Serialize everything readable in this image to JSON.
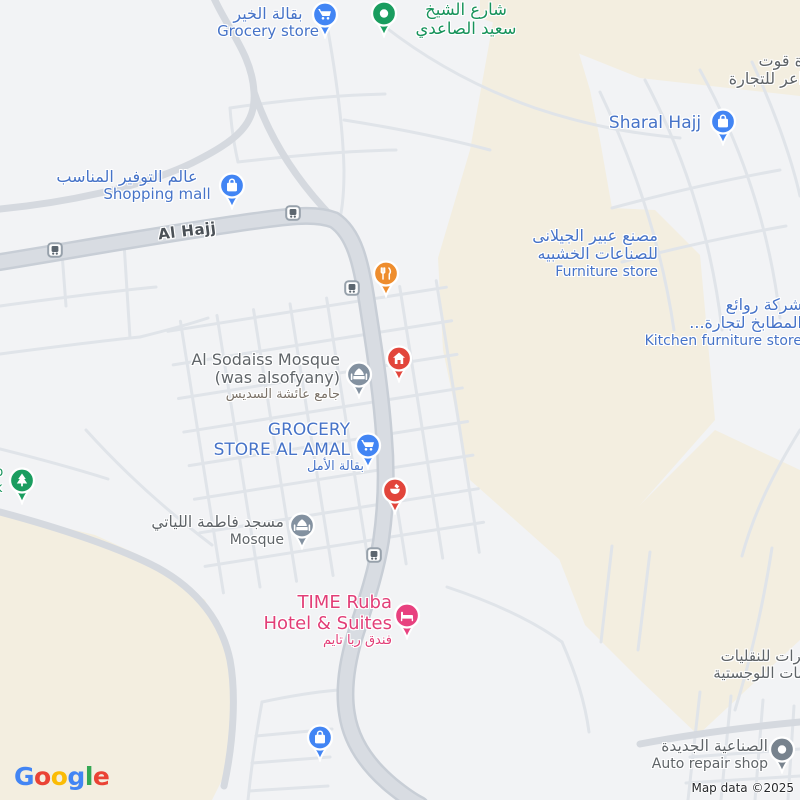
{
  "attribution": "Map data ©2025",
  "logo": {
    "letters": [
      "G",
      "o",
      "o",
      "g",
      "l",
      "e"
    ]
  },
  "colors": {
    "poi_label_blue": "#4673c8",
    "street_green": "#17935b",
    "hotel_pink": "#e23e77",
    "label_gray": "#5f6468",
    "marker_blue": "#4285f4",
    "marker_red": "#e2453b",
    "marker_orange": "#ee8d2e",
    "marker_gray": "#8391a0",
    "marker_pink": "#e8417f",
    "marker_green": "#1a9d5f",
    "landuse_beige": "#f3eee0",
    "road_fill": "#d8dce2"
  },
  "roads": {
    "al_hajj": "Al Hajj"
  },
  "street_names": {
    "sheikh_l1": "شارع الشيخ",
    "sheikh_l2": "سعيد الصاعدي"
  },
  "pois": {
    "grocery_khair": {
      "ar": "بقالة الخير",
      "en": "Grocery store",
      "marker": "cart-blue"
    },
    "qut_trading": {
      "l1": "ة قوت",
      "l2": "اعر للتجارة"
    },
    "sharal_hajj": {
      "en": "Sharal Hajj",
      "marker": "bag-blue"
    },
    "shopping_mall": {
      "ar": "عالم التوفير المناسب",
      "en": "Shopping mall",
      "marker": "bag-blue"
    },
    "furniture_store": {
      "ar1": "مصنع عبير الجيلانى",
      "ar2": "للصناعات الخشبيه",
      "en": "Furniture store",
      "marker": "bag-blue"
    },
    "kitchen_store": {
      "ar1": "شركة روائع",
      "ar2": "المطابخ لتجارة...",
      "en": "Kitchen furniture store"
    },
    "sodaiss_mosque": {
      "en1": "Al Sodaiss Mosque",
      "en2": "(was alsofyany)",
      "ar": "جامع عائشة السديس",
      "marker": "mosque-gray"
    },
    "home": {
      "marker": "home-red"
    },
    "restaurant": {
      "marker": "restaurant-orange"
    },
    "grocery_amal": {
      "en1": "GROCERY",
      "en2": "STORE AL AMAL",
      "ar": "بقالة الأمل",
      "marker": "cart-blue"
    },
    "pharmacy_poi": {
      "marker": "mortar-red"
    },
    "fatima_mosque": {
      "ar": "مسجد فاطمة اللياتي",
      "en": "Mosque",
      "marker": "mosque-gray"
    },
    "hotel": {
      "en1": "TIME Ruba",
      "en2": "Hotel & Suites",
      "ar": "فندق ربا تايم",
      "marker": "bed-pink"
    },
    "park": {
      "l1": "p",
      "l2": "k",
      "marker": "tree-green"
    },
    "shop_south": {
      "marker": "bag-blue"
    },
    "transport_co": {
      "l1": "يرات للنقليات",
      "l2": "مات اللوجستية"
    },
    "auto_repair": {
      "ar": "الصناعية الجديدة",
      "en": "Auto repair shop",
      "marker": "dot-gray"
    }
  }
}
